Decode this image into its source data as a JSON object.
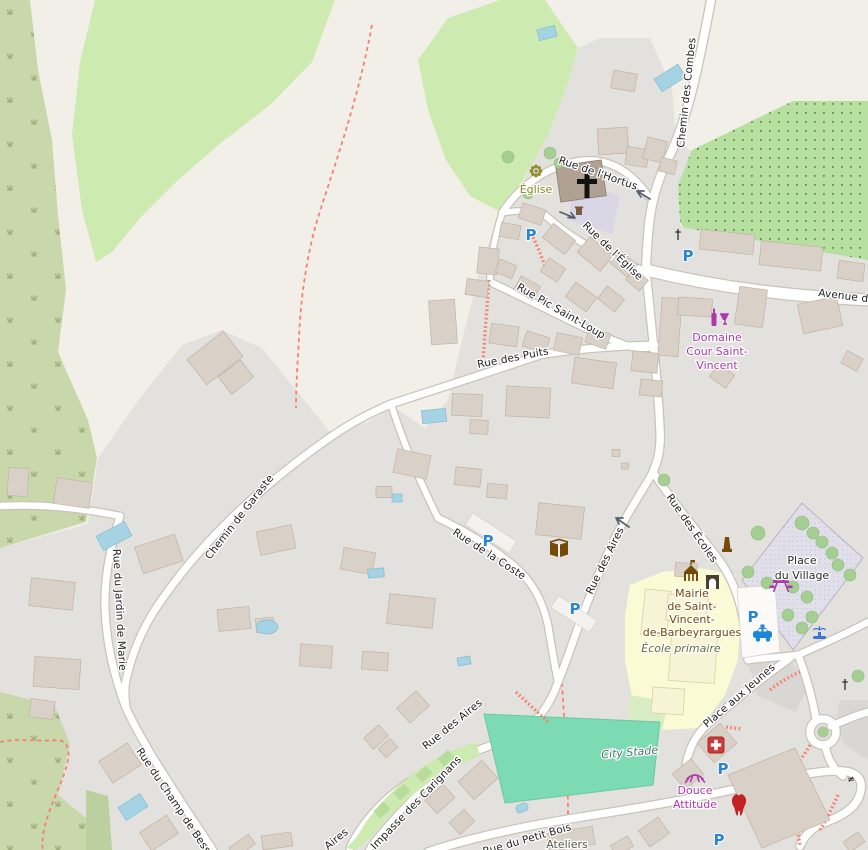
{
  "map_title": "Saint-Vincent-de-Barbeyrargues village map",
  "colors": {
    "poi_purple": "#ac39ac",
    "poi_brown": "#734a08",
    "parking_blue": "#2a85d0",
    "pharmacy_red": "#cd3a3a",
    "pitch_green": "#7ddbb3",
    "school_yellow": "#fafad5",
    "pedestrian_square": "#e0dfea",
    "water_blue": "#a6d3e4"
  },
  "icons": {
    "parking": "P",
    "cross": "†",
    "gate": "≠"
  },
  "streets": [
    {
      "name": "Chemin des Combes"
    },
    {
      "name": "Rue de l'Hortus"
    },
    {
      "name": "Rue de l'Église"
    },
    {
      "name": "Rue Pic Saint-Loup"
    },
    {
      "name": "Rue des Puits"
    },
    {
      "name": "Avenue de"
    },
    {
      "name": "Chemin de Garaste"
    },
    {
      "name": "Rue de la Coste"
    },
    {
      "name": "Rue des Aires"
    },
    {
      "name": "Rue des Écoles"
    },
    {
      "name": "Rue du Jardin de Marie"
    },
    {
      "name": "Rue du Champ de Bessou"
    },
    {
      "name": "Rue des Aires"
    },
    {
      "name": "Impasse des Carignans"
    },
    {
      "name": "Rue du Petit Bois"
    },
    {
      "name": "Place aux Jeunes"
    },
    {
      "name": "Aires"
    }
  ],
  "pois": {
    "eglise": {
      "label": "Église"
    },
    "domaine": {
      "line1": "Domaine",
      "line2": "Cour Saint-",
      "line3": "Vincent"
    },
    "mairie": {
      "line1": "Mairie",
      "line2": "de Saint-",
      "line3": "Vincent-",
      "line4": "de-Bar​beyrargues"
    },
    "ecole": {
      "label": "École primaire"
    },
    "place_village": {
      "line1": "Place",
      "line2": "du Village"
    },
    "city_stade": {
      "label": "City Stade"
    },
    "douce": {
      "line1": "Douce",
      "line2": "Attitude"
    },
    "ateliers": {
      "label": "Ateliers"
    }
  }
}
